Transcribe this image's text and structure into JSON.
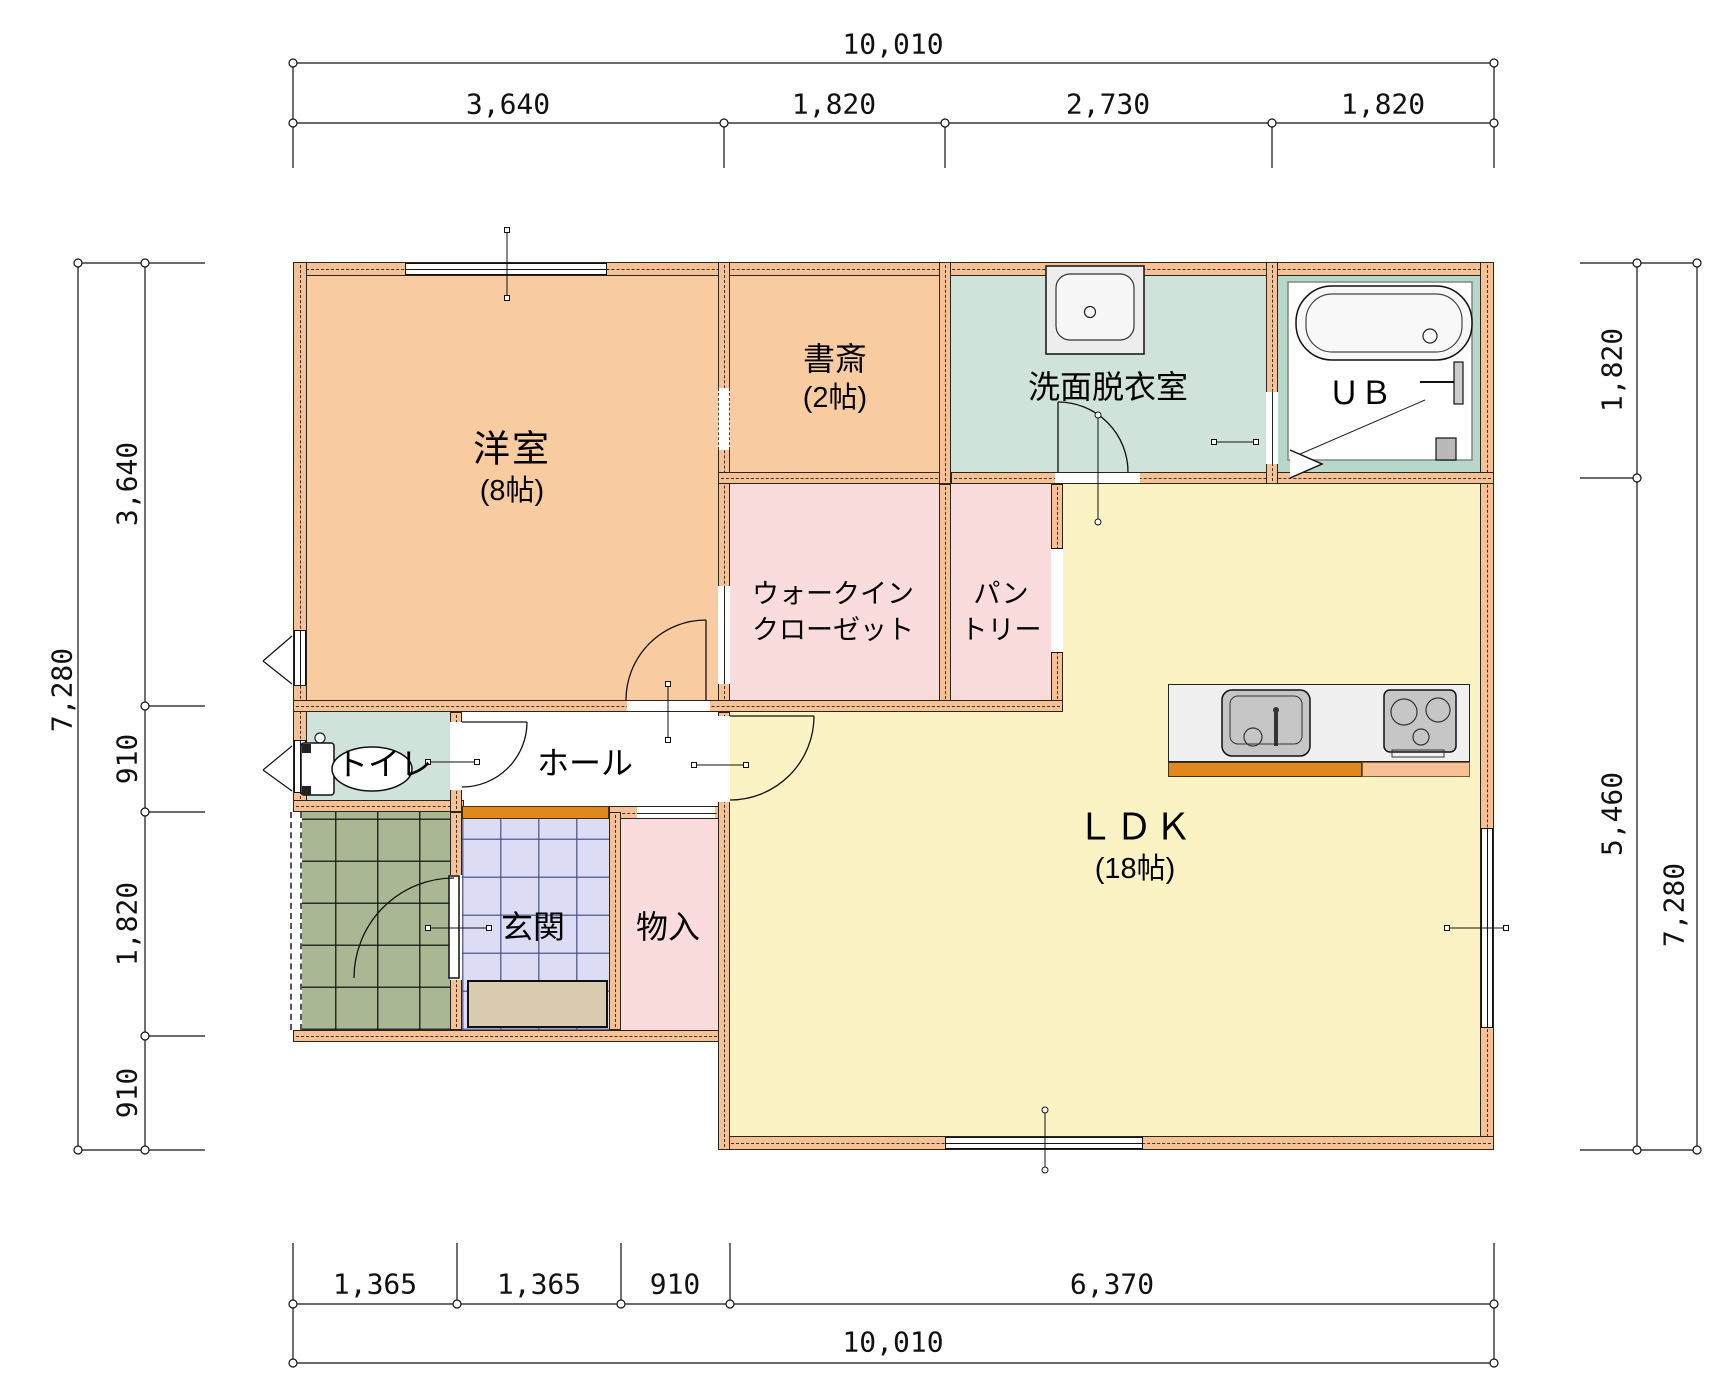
{
  "plan": {
    "rooms": {
      "yoshitsu": {
        "name": "洋室",
        "size": "(8帖)"
      },
      "shosai": {
        "name": "書斎",
        "size": "(2帖)"
      },
      "senmen": {
        "name": "洗面脱衣室"
      },
      "unit_bath": {
        "name": "ＵＢ"
      },
      "walk_in_closet": {
        "line1": "ウォークイン",
        "line2": "クローゼット"
      },
      "pantry": {
        "line1": "パン",
        "line2": "トリー"
      },
      "toilet": {
        "name": "トイレ"
      },
      "hall": {
        "name": "ホール"
      },
      "genkan": {
        "name": "玄関"
      },
      "mono_ire": {
        "name": "物入"
      },
      "ldk": {
        "name": "ＬＤＫ",
        "size": "(18帖)"
      }
    },
    "dimensions": {
      "top": {
        "total": "10,010",
        "segments": [
          "3,640",
          "1,820",
          "2,730",
          "1,820"
        ]
      },
      "left": {
        "total": "7,280",
        "segments": [
          "3,640",
          "910",
          "1,820",
          "910"
        ]
      },
      "right": {
        "total": "7,280",
        "segments": [
          "1,820",
          "5,460"
        ]
      },
      "bottom": {
        "total": "10,010",
        "segments": [
          "1,365",
          "1,365",
          "910",
          "6,370"
        ]
      }
    },
    "colors": {
      "wall": "#f6c295",
      "room_orange": "#f8cba0",
      "room_pink": "#fadcdc",
      "room_teal": "#cfe3da",
      "room_yellow": "#fcf3c5",
      "ub_frame": "#b7d7ca",
      "genkan_tile": "#dcdcf4",
      "porch_tile": "#a9b795",
      "step_accent": "#e0881c"
    }
  }
}
